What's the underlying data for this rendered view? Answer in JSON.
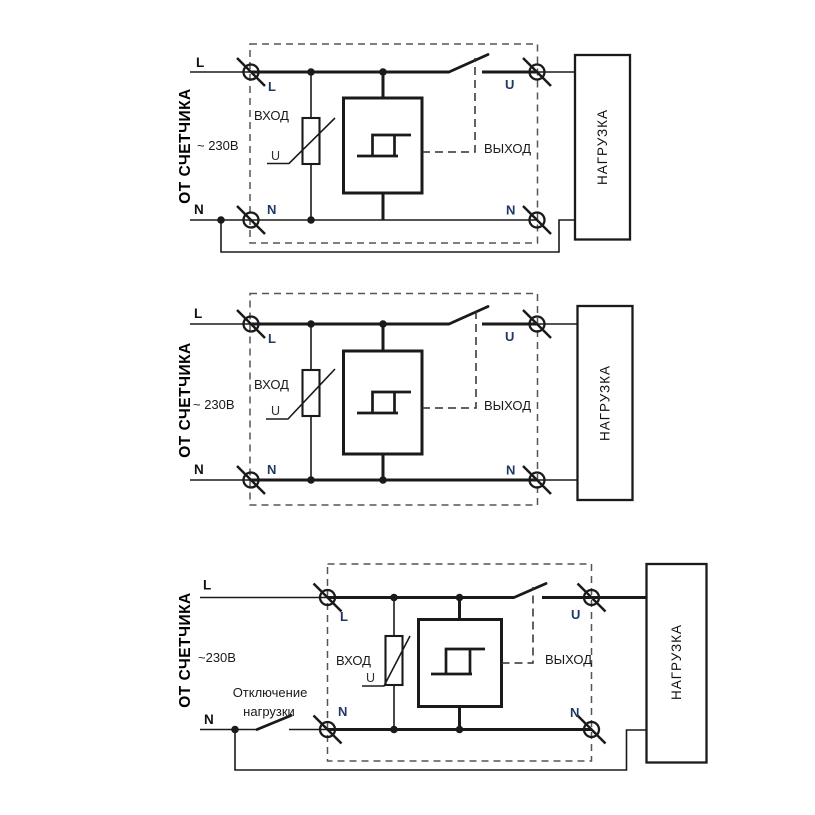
{
  "page": {
    "background": "#ffffff"
  },
  "colors": {
    "wire": "#1a1a1a",
    "terminal_label": "#1f3864",
    "text": "#1a1a1a",
    "dashed_outline": "#555555"
  },
  "diagrams": [
    {
      "meter_label": "ОТ СЧЕТЧИКА",
      "voltage": "~ 230В",
      "line_labels": {
        "l_outer": "L",
        "n_outer": "N"
      },
      "terminals": {
        "l_in": "L",
        "n_in": "N",
        "u_out": "U",
        "n_out": "N"
      },
      "device": {
        "input": "ВХОД",
        "output": "ВЫХОД",
        "varistor": "U"
      },
      "load": "НАГРУЗКА"
    },
    {
      "meter_label": "ОТ СЧЕТЧИКА",
      "voltage": "~ 230В",
      "line_labels": {
        "l_outer": "L",
        "n_outer": "N"
      },
      "terminals": {
        "l_in": "L",
        "n_in": "N",
        "u_out": "U",
        "n_out": "N"
      },
      "device": {
        "input": "ВХОД",
        "output": "ВЫХОД",
        "varistor": "U"
      },
      "load": "НАГРУЗКА"
    },
    {
      "meter_label": "ОТ СЧЕТЧИКА",
      "voltage": "~230В",
      "line_labels": {
        "l_outer": "L",
        "n_outer": "N"
      },
      "terminals": {
        "l_in": "L",
        "n_in": "N",
        "u_out": "U",
        "n_out": "N"
      },
      "device": {
        "input": "ВХОД",
        "output": "ВЫХОД",
        "varistor": "U"
      },
      "load": "НАГРУЗКА",
      "disconnect": {
        "line1": "Отключение",
        "line2": "нагрузки"
      }
    }
  ]
}
